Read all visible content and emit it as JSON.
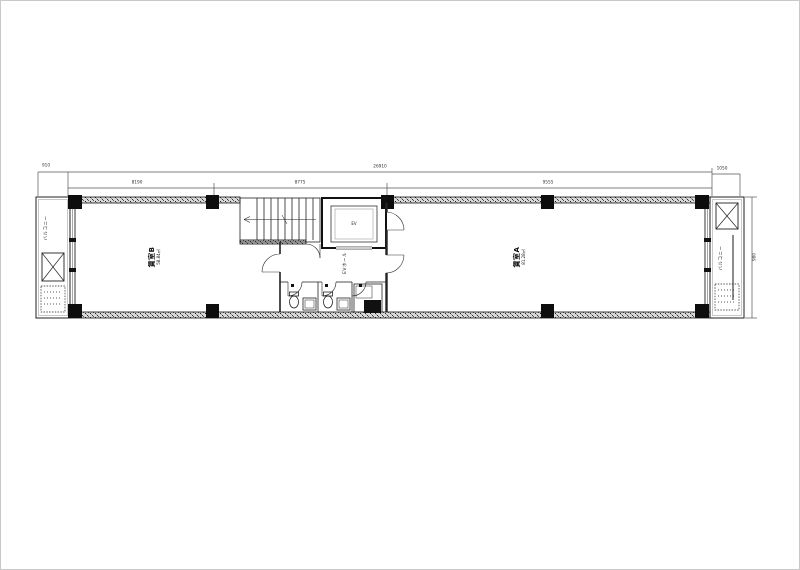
{
  "plan": {
    "rooms": {
      "room_a": {
        "label": "賃室A",
        "area": "81.28㎡"
      },
      "room_b": {
        "label": "賃室B",
        "area": "58.84㎡"
      }
    },
    "core": {
      "ev_hall": "EVホール",
      "ev": "EV"
    },
    "balconies": {
      "left": "バルコニー",
      "right": "バルコニー"
    },
    "dimensions": {
      "left_offset": "910",
      "total": "26910",
      "seg1": "8190",
      "seg2": "8775",
      "seg3": "9555",
      "right_offset": "1050",
      "depth": "980"
    },
    "colors": {
      "line": "#1a1a1a",
      "wall_fill": "#d9d9d9"
    }
  }
}
